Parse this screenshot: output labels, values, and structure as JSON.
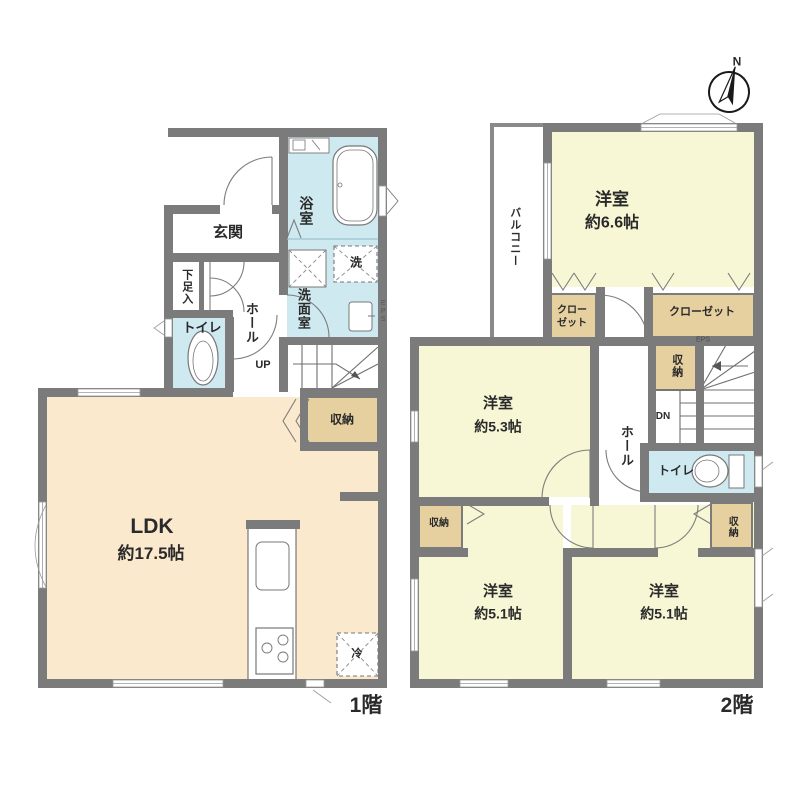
{
  "compass": {
    "north": "N"
  },
  "floor1": {
    "floor_label": "1階",
    "entrance": "玄関",
    "shoe_storage": "下足入",
    "toilet": "トイレ",
    "hall": "ホール",
    "bathroom": "浴室",
    "washroom": "洗面室",
    "laundry": "洗",
    "stairs_up": "UP",
    "storage": "収納",
    "ldk_name": "LDK",
    "ldk_size": "約17.5帖",
    "fridge": "冷",
    "shaft": "EPS"
  },
  "floor2": {
    "floor_label": "2階",
    "balcony": "バルコニー",
    "room_66_name": "洋室",
    "room_66_size": "約6.6帖",
    "closet_small_line1": "クロー",
    "closet_small_line2": "ゼット",
    "closet_large": "クローゼット",
    "storage_stairs": "収納",
    "stairs_down": "DN",
    "hall": "ホール",
    "toilet": "トイレ",
    "storage_left": "収納",
    "storage_right": "収納",
    "room_53_name": "洋室",
    "room_53_size": "約5.3帖",
    "room_51a_name": "洋室",
    "room_51a_size": "約5.1帖",
    "room_51b_name": "洋室",
    "room_51b_size": "約5.1帖",
    "shaft": "EPS"
  },
  "colors": {
    "wall": "#7b7b7b",
    "ldk_floor": "#fbe9cd",
    "bedroom_floor": "#f7f7d6",
    "wet_area_floor": "#cfe9f1",
    "closet": "#e6d0a0"
  }
}
